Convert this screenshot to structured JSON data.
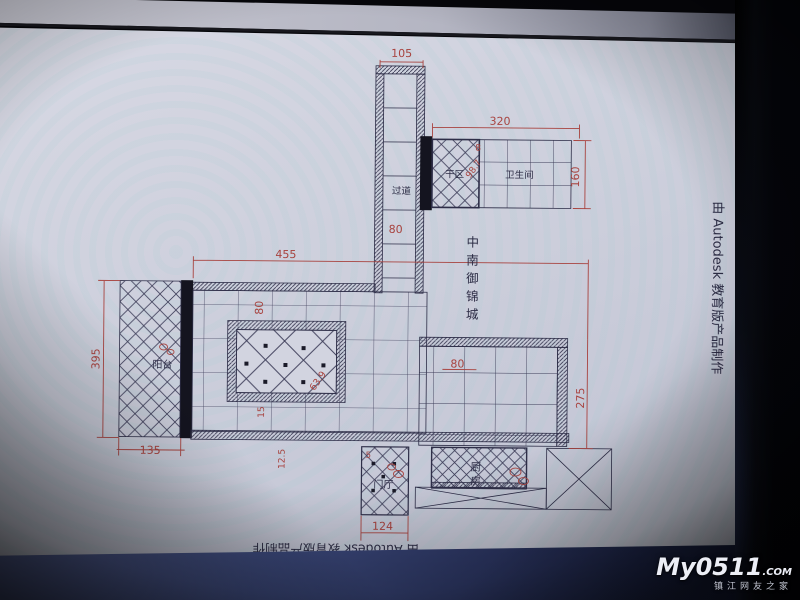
{
  "drawing": {
    "project_chars": {
      "c1": "中",
      "c2": "南",
      "c3": "御",
      "c4": "锦",
      "c5": "城"
    },
    "rooms": {
      "corridor": "过道",
      "dry_area": "干区",
      "bathroom": "卫生间",
      "balcony": "阳台",
      "entry": "门厅",
      "kitchen_c1": "厨",
      "kitchen_c2": "房"
    },
    "dims": {
      "top_width": "105",
      "corridor_w": "80",
      "annex_width": "320",
      "annex_gap": "8",
      "annex_diag": "98.7",
      "annex_height": "160",
      "band_width": "455",
      "band_gap": "80",
      "ceiling_diag": "63.9",
      "gap_15": "15",
      "gap_125": "12.5",
      "balcony_height": "395",
      "balcony_width": "135",
      "room_tile": "80",
      "room_height": "275",
      "entry_gap": "5",
      "entry_width": "124"
    },
    "credit_bottom": "由 Autodesk 教育版产品制作",
    "credit_right": "由 Autodesk 教育版产品制作",
    "colors": {
      "dim_red": "#a8433f",
      "line": "#2e2e48",
      "wall_fill": "#14141f",
      "paper": "#d2d4e0"
    }
  },
  "watermark": {
    "logo": "My0511",
    "dot_com": ".COM",
    "tagline": "镇江网友之家"
  }
}
